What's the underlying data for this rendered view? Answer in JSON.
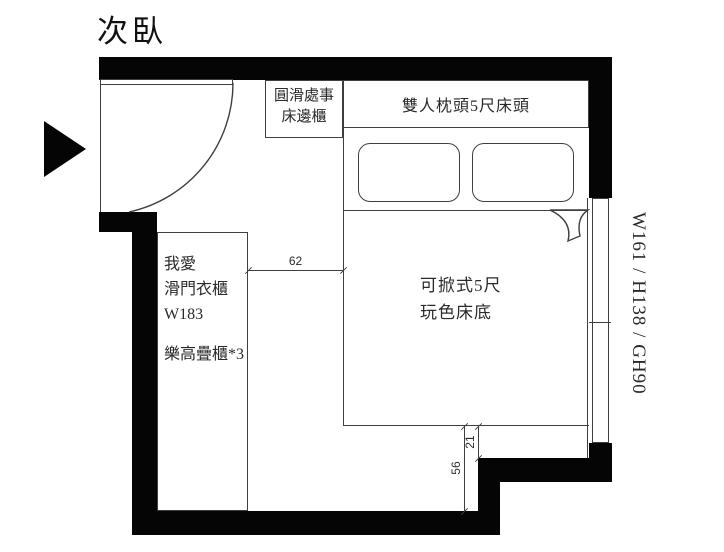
{
  "page": {
    "title": "次臥"
  },
  "colors": {
    "wall": "#050505",
    "line": "#3f3f3f",
    "background": "#ffffff",
    "text": "#2a2a2a"
  },
  "icons": {
    "entrance_arrow": "right-pointing-triangle"
  },
  "furniture": {
    "bedside_cabinet": {
      "label_lines": [
        "圓滑處事",
        "床邊櫃"
      ]
    },
    "headboard": {
      "label": "雙人枕頭5尺床頭"
    },
    "pillows": {
      "count": 2
    },
    "bed": {
      "label_lines": [
        "可掀式5尺",
        "玩色床底"
      ]
    },
    "wardrobe": {
      "label_lines": [
        "我愛",
        "滑門衣櫃",
        "W183"
      ],
      "extra_label": "樂高疊櫃*3"
    }
  },
  "window": {
    "label": "W161 / H138 / GH90"
  },
  "dimensions": [
    {
      "id": "wardrobe-to-bed",
      "value": "62",
      "orientation": "horizontal"
    },
    {
      "id": "bed-to-step-wall",
      "value": "21",
      "orientation": "vertical"
    },
    {
      "id": "bed-to-bottom-wall",
      "value": "56",
      "orientation": "vertical"
    }
  ]
}
